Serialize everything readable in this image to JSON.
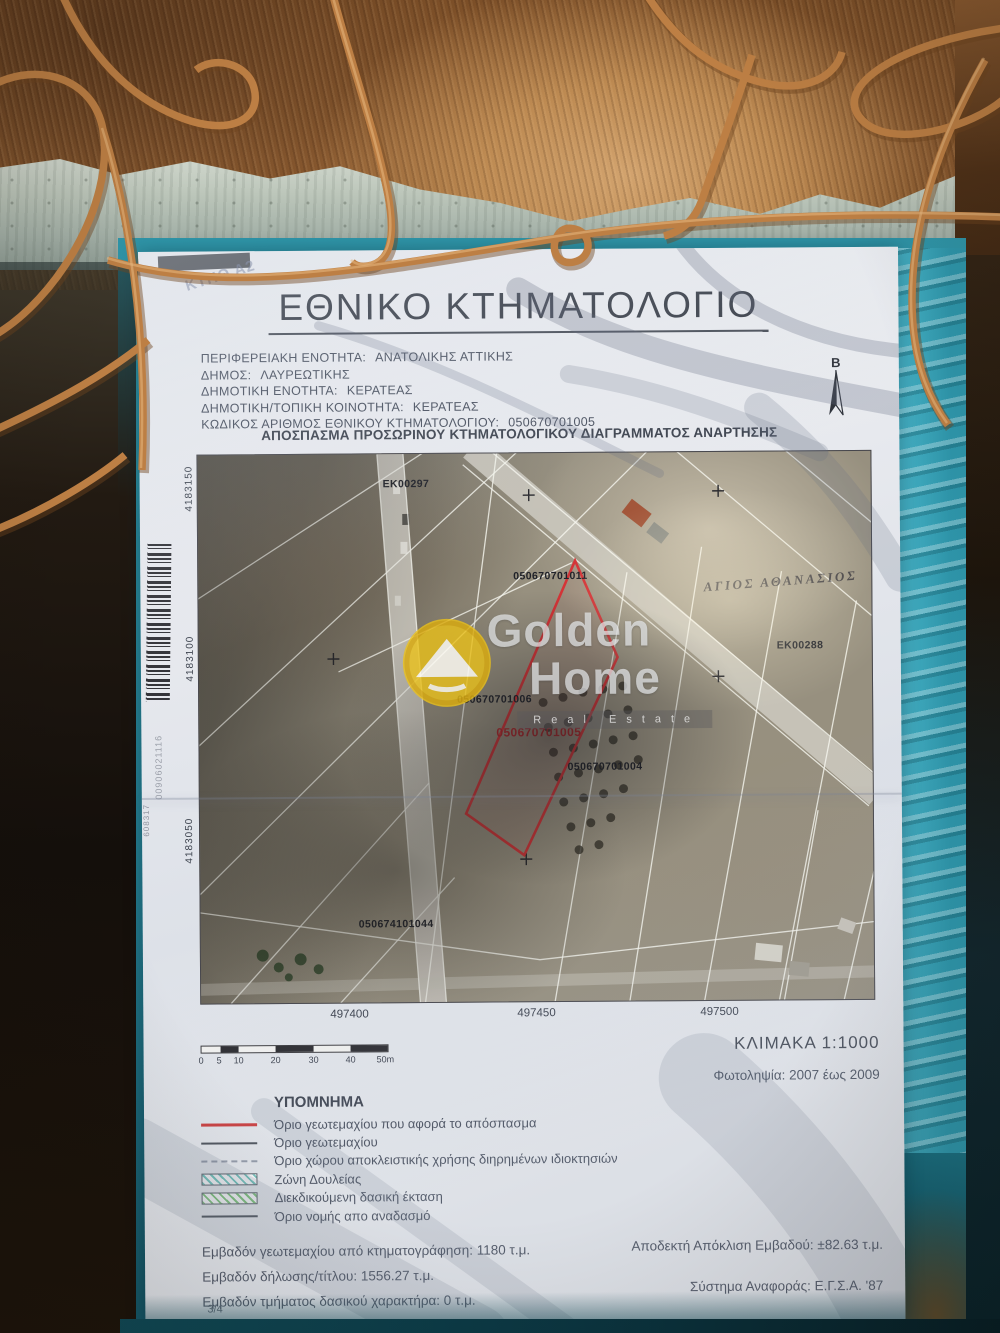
{
  "colors": {
    "parcel_red": "#d43437",
    "folder_teal": "#2e95a8",
    "rust_wire": "#bd7f44",
    "paper": "#e9ebee",
    "watermark_yellow": "#edc218"
  },
  "doc": {
    "title": "ΕΘΝΙΚΟ ΚΤΗΜΑΤΟΛΟΓΙΟ",
    "corner_note": "ΚΤΗΘ Α2",
    "meta": [
      {
        "label": "ΠΕΡΙΦΕΡΕΙΑΚΗ ΕΝΟΤΗΤΑ:",
        "value": "ΑΝΑΤΟΛΙΚΗΣ ΑΤΤΙΚΗΣ"
      },
      {
        "label": "ΔΗΜΟΣ:",
        "value": "ΛΑΥΡΕΩΤΙΚΗΣ"
      },
      {
        "label": "ΔΗΜΟΤΙΚΗ ΕΝΟΤΗΤΑ:",
        "value": "ΚΕΡΑΤΕΑΣ"
      },
      {
        "label": "ΔΗΜΟΤΙΚΗ/ΤΟΠΙΚΗ ΚΟΙΝΟΤΗΤΑ:",
        "value": "ΚΕΡΑΤΕΑΣ"
      },
      {
        "label": "ΚΩΔΙΚΟΣ ΑΡΙΘΜΟΣ ΕΘΝΙΚΟΥ ΚΤΗΜΑΤΟΛΟΓΙΟΥ:",
        "value": "050670701005"
      }
    ],
    "north_label": "Β",
    "subtitle": "ΑΠΟΣΠΑΣΜΑ ΠΡΟΣΩΡΙΝΟΥ ΚΤΗΜΑΤΟΛΟΓΙΚΟΥ ΔΙΑΓΡΑΜΜΑΤΟΣ ΑΝΑΡΤΗΣΗΣ",
    "scale_text": "ΚΛΙΜΑΚΑ 1:1000",
    "photo_dates": "Φωτοληψία: 2007 έως 2009",
    "page": "3/4"
  },
  "map": {
    "labels": [
      {
        "text": "EK00297"
      },
      {
        "text": "050670701011"
      },
      {
        "text": "ΑΓΙΟΣ ΑΘΑΝΑΣΙΟΣ"
      },
      {
        "text": "EK00288"
      },
      {
        "text": "050670701006"
      },
      {
        "text": "050670701005"
      },
      {
        "text": "050670701004"
      },
      {
        "text": "050674101044"
      }
    ],
    "margin": {
      "northing_top": "4183150",
      "northing_mid": "4183100",
      "northing_bottom": "4183050",
      "code_a": "00906021116",
      "code_b": "608317"
    },
    "eastings": [
      "497400",
      "497450",
      "497500"
    ]
  },
  "scalebar": {
    "ticks": [
      "0",
      "5",
      "10",
      "20",
      "30",
      "40",
      "50m"
    ]
  },
  "legend": {
    "title": "ΥΠΟΜΝΗΜΑ",
    "items": [
      {
        "symbol": "line-red",
        "label": "Όριο γεωτεμαχίου που αφορά το απόσπασμα"
      },
      {
        "symbol": "line-dark",
        "label": "Όριο γεωτεμαχίου"
      },
      {
        "symbol": "line-dashed",
        "label": "Όριο χώρου αποκλειστικής χρήσης διηρημένων ιδιοκτησιών"
      },
      {
        "symbol": "hatch-teal",
        "label": "Ζώνη Δουλείας"
      },
      {
        "symbol": "hatch-green",
        "label": "Διεκδικούμενη δασική έκταση"
      },
      {
        "symbol": "line-dark",
        "label": "Όριο νομής απο αναδασμό"
      }
    ]
  },
  "stats": {
    "left": [
      "Εμβαδόν γεωτεμαχίου από κτηματογράφηση: 1180 τ.μ.",
      "Εμβαδόν δήλωσης/τίτλου: 1556.27 τ.μ.",
      "Εμβαδόν τμήματος δασικού χαρακτήρα: 0 τ.μ."
    ],
    "right": [
      "Αποδεκτή Απόκλιση Εμβαδού: ±82.63 τ.μ.",
      "Σύστημα Αναφοράς: Ε.Γ.Σ.Α. '87"
    ]
  },
  "watermark": {
    "l1": "Golden",
    "l2": "Home",
    "l3": "Real Estate"
  }
}
